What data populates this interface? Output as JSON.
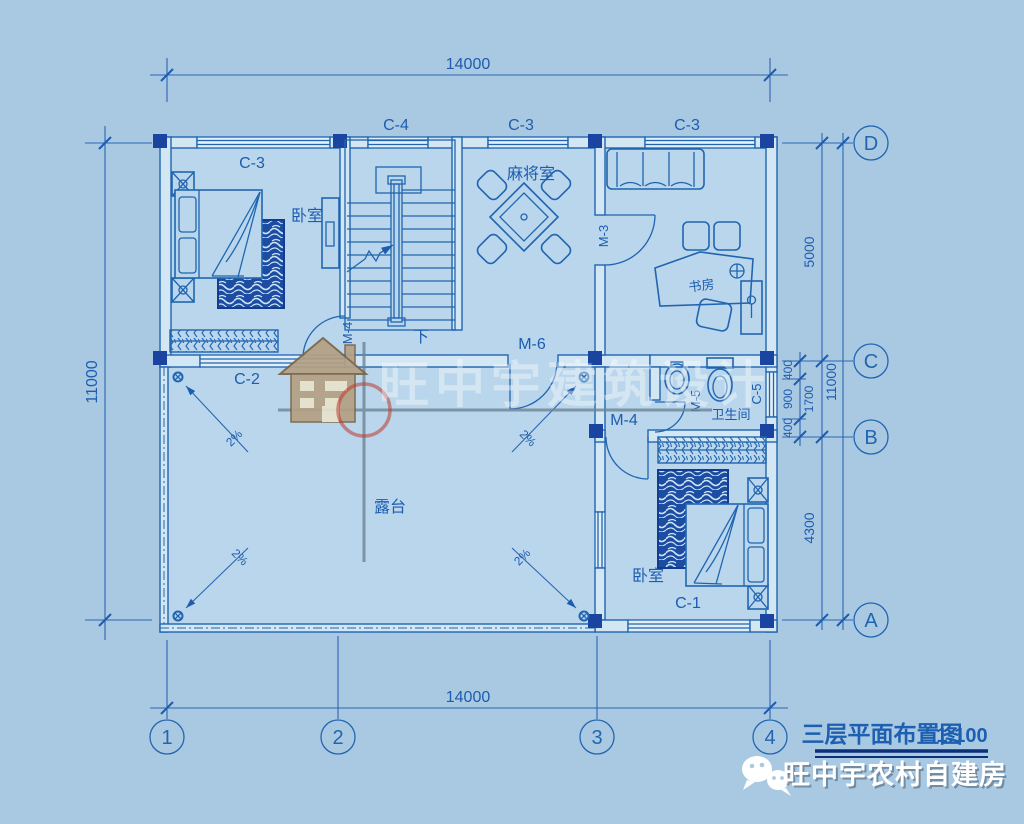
{
  "colors": {
    "background": "#a9c9e3",
    "interior": "#b9d6ec",
    "line_blue": "#2165b0",
    "dark_navy": "#1a44a0",
    "dim_text": "#1d5cae",
    "title_underline": "#0b2f78",
    "watermark_red": "#c0392b",
    "watermark_tan": "#b4a084",
    "brand_text": "#ffffff"
  },
  "axes": {
    "horizontal": [
      "1",
      "2",
      "3",
      "4"
    ],
    "vertical": [
      "A",
      "B",
      "C",
      "D"
    ]
  },
  "dimensions": {
    "top": "14000",
    "bottom": "14000",
    "left": "11000",
    "right_overall": "11000",
    "right_upper": "5000",
    "right_sub": [
      "400",
      "900",
      "400"
    ],
    "right_mid": "1700",
    "right_lower": "4300"
  },
  "rooms": {
    "bedroom_top": "卧室",
    "bedroom_bottom": "卧室",
    "mahjong": "麻将室",
    "study": "书房",
    "bathroom": "卫生间",
    "terrace": "露台",
    "stair_down": "下"
  },
  "windows": {
    "c3_bedroom": "C-3",
    "c4_stair": "C-4",
    "c3_mahjong": "C-3",
    "c3_study": "C-3",
    "c2_terrace": "C-2",
    "c1_bedroom": "C-1",
    "c5_bathroom": "C-5"
  },
  "doors": {
    "m4_bedroom_top": "M-4",
    "m3_study": "M-3",
    "m6_terrace": "M-6",
    "m5_bathroom": "M-5",
    "m4_bedroom_bottom": "M-4"
  },
  "slope_labels": [
    "2%",
    "2%",
    "2%",
    "2%"
  ],
  "title": {
    "name": "三层平面布置图",
    "scale": "1:100"
  },
  "watermark": {
    "text": "旺中宇建筑设计"
  },
  "brand": {
    "text": "旺中宇农村自建房"
  }
}
